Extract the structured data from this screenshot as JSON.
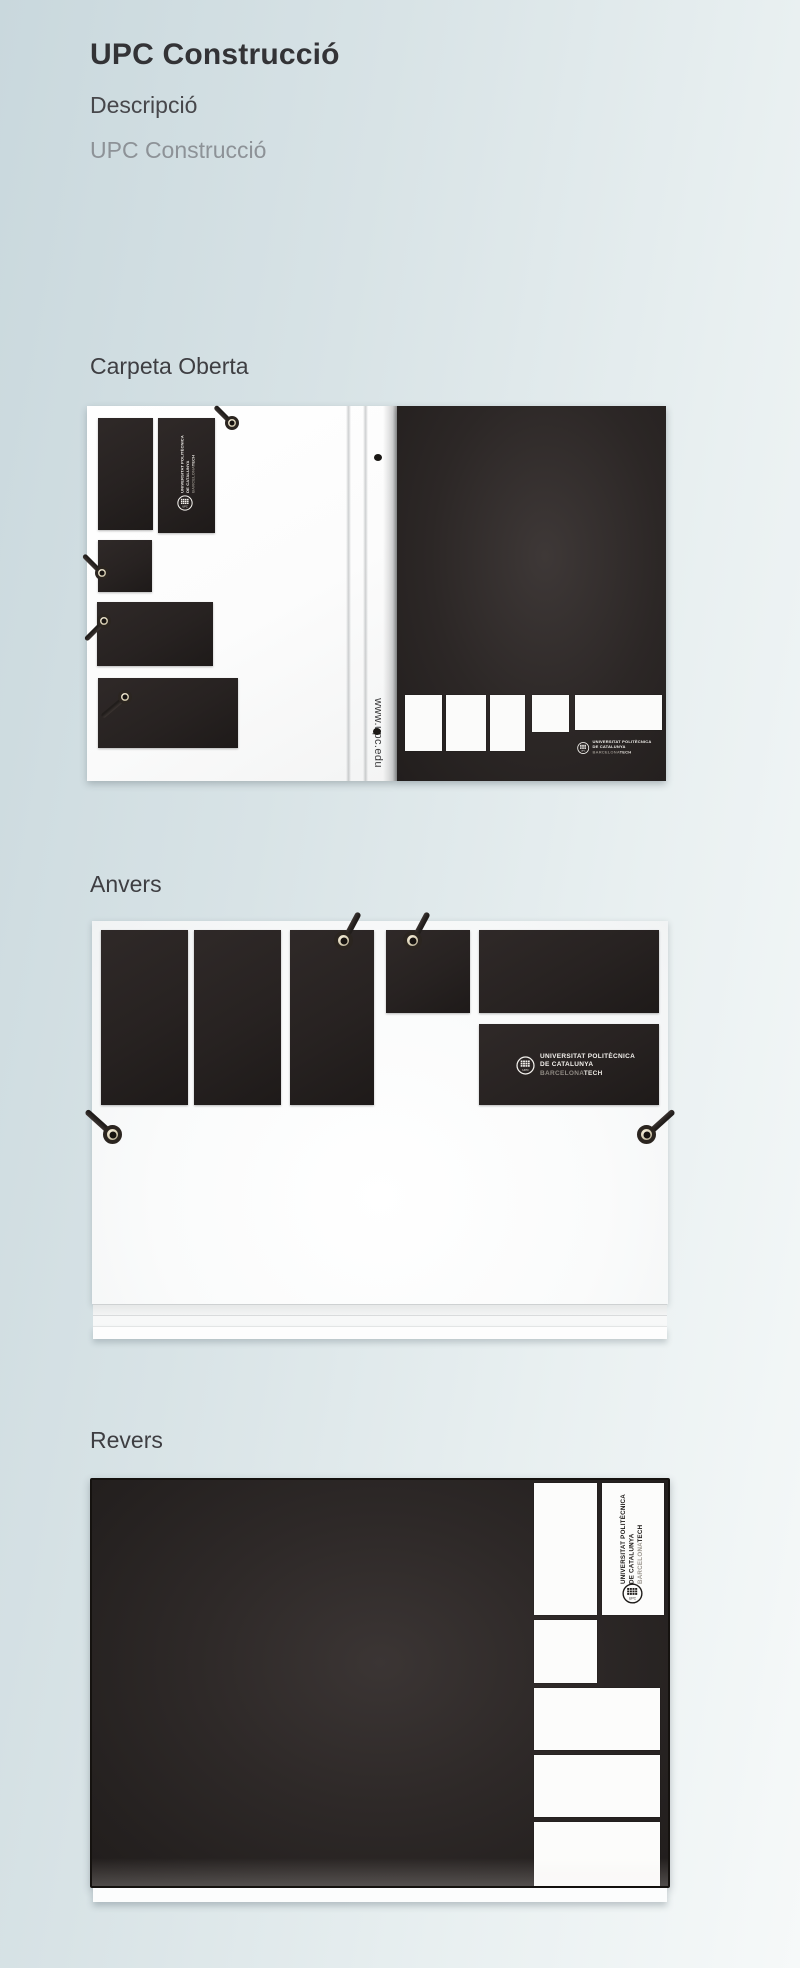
{
  "page": {
    "title": "UPC Construcció",
    "subtitle_label": "Descripció",
    "subtitle_value": "UPC Construcció"
  },
  "sections": {
    "open": {
      "heading": "Carpeta Oberta"
    },
    "front": {
      "heading": "Anvers"
    },
    "back": {
      "heading": "Revers"
    }
  },
  "artwork": {
    "spine_url": "www.upc.edu",
    "logo": {
      "emblem_text": "UPC",
      "line1": "UNIVERSITAT POLITÈCNICA",
      "line2": "DE CATALUNYA",
      "line3a": "BARCELONA",
      "line3b": "TECH"
    },
    "colors": {
      "background_left": "#c9d8dd",
      "background_right": "#f6f9f9",
      "card_black": "#272221",
      "cover_black": "#2e2928",
      "page_white": "#fcfcfc"
    }
  }
}
